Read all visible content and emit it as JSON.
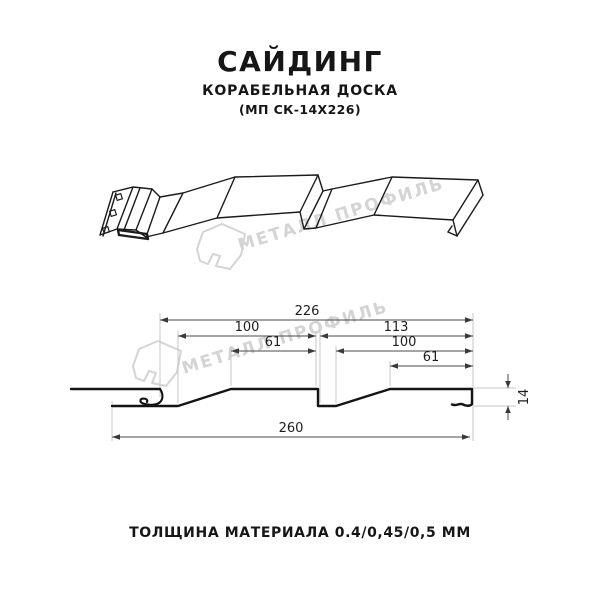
{
  "header": {
    "title": "САЙДИНГ",
    "subtitle": "КОРАБЕЛЬНАЯ ДОСКА",
    "code": "(МП СК-14Х226)"
  },
  "watermark": {
    "brand": "МЕТАЛЛ ПРОФИЛЬ",
    "color": "#d4d4d4"
  },
  "section": {
    "dims": {
      "d226": "226",
      "d100_left": "100",
      "d113": "113",
      "d61_left": "61",
      "d100_right": "100",
      "d61_right": "61",
      "d260": "260",
      "d14": "14"
    }
  },
  "footer": {
    "thickness_label": "ТОЛЩИНА МАТЕРИАЛА 0.4/0,45/0,5 ММ"
  },
  "colors": {
    "line": "#1b1b1b",
    "dimension": "#4a4a4a",
    "extension": "#c7c7c7",
    "watermark": "#d4d4d4",
    "background": "#ffffff"
  }
}
